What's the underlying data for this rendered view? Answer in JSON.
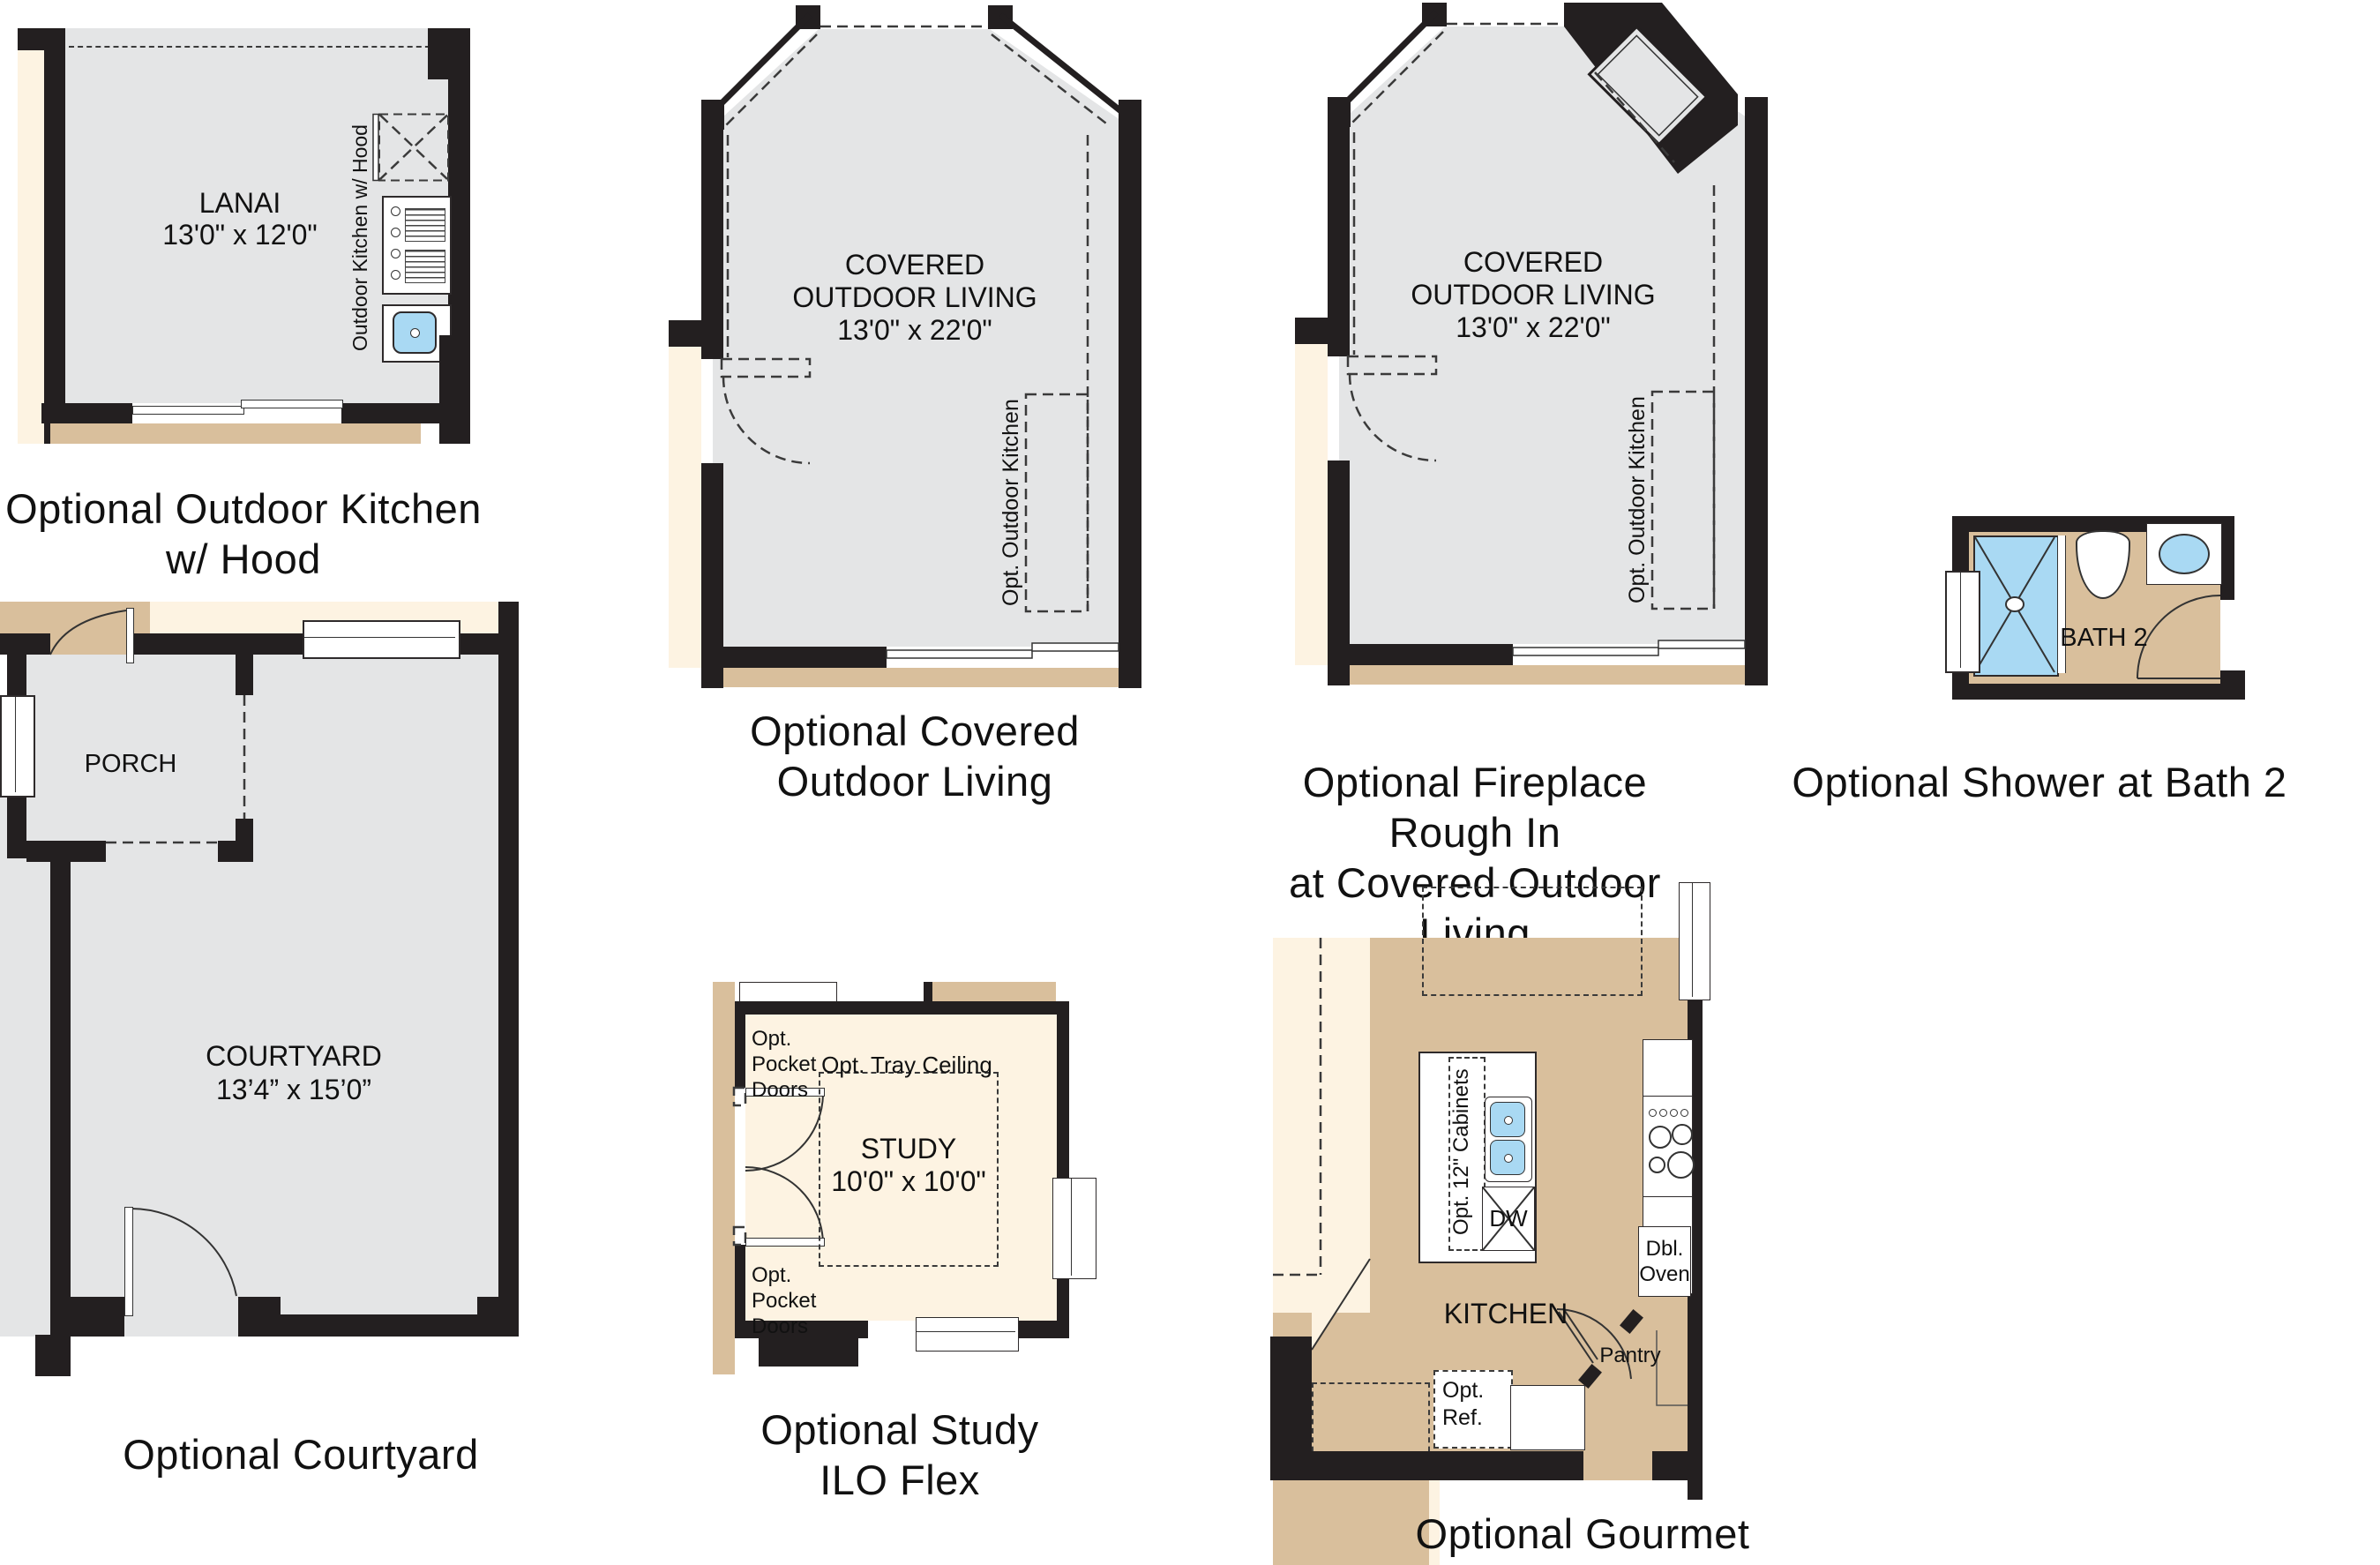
{
  "palette": {
    "wall": "#231f20",
    "floor_gray": "#e4e5e6",
    "tan": "#d9bf9c",
    "cream": "#fdf3e2",
    "fixture_blue": "#a9d9f3"
  },
  "plans": {
    "outdoor_kitchen": {
      "room_name": "LANAI",
      "room_dims": "13'0\" x 12'0\"",
      "fixture_label": "Outdoor Kitchen w/ Hood",
      "caption": "Optional Outdoor Kitchen\nw/ Hood"
    },
    "covered_outdoor_living": {
      "room_line1": "COVERED",
      "room_line2": "OUTDOOR LIVING",
      "room_dims": "13'0\" x 22'0\"",
      "fixture_label": "Opt. Outdoor Kitchen",
      "caption": "Optional Covered\nOutdoor Living"
    },
    "fireplace_outdoor_living": {
      "room_line1": "COVERED",
      "room_line2": "OUTDOOR LIVING",
      "room_dims": "13'0\" x 22'0\"",
      "fixture_label": "Opt. Outdoor Kitchen",
      "caption": "Optional Fireplace Rough In\nat Covered Outdoor Living"
    },
    "shower_bath2": {
      "room_name": "BATH 2",
      "caption": "Optional Shower at Bath 2"
    },
    "courtyard": {
      "porch_name": "PORCH",
      "room_name": "COURTYARD",
      "room_dims": "13’4” x 15’0”",
      "caption": "Optional Courtyard"
    },
    "study": {
      "room_name": "STUDY",
      "room_dims": "10'0\" x 10'0\"",
      "pocket_doors": "Opt.\nPocket\nDoors",
      "tray_ceiling": "Opt. Tray Ceiling",
      "caption": "Optional Study\nILO Flex"
    },
    "kitchen": {
      "room_name": "KITCHEN",
      "cabinets": "Opt. 12\" Cabinets",
      "dishwasher": "DW",
      "double_oven": "Dbl.\nOven",
      "pantry": "Pantry",
      "refrigerator": "Opt.\nRef.",
      "caption": "Optional Gourmet Kitchen"
    }
  }
}
